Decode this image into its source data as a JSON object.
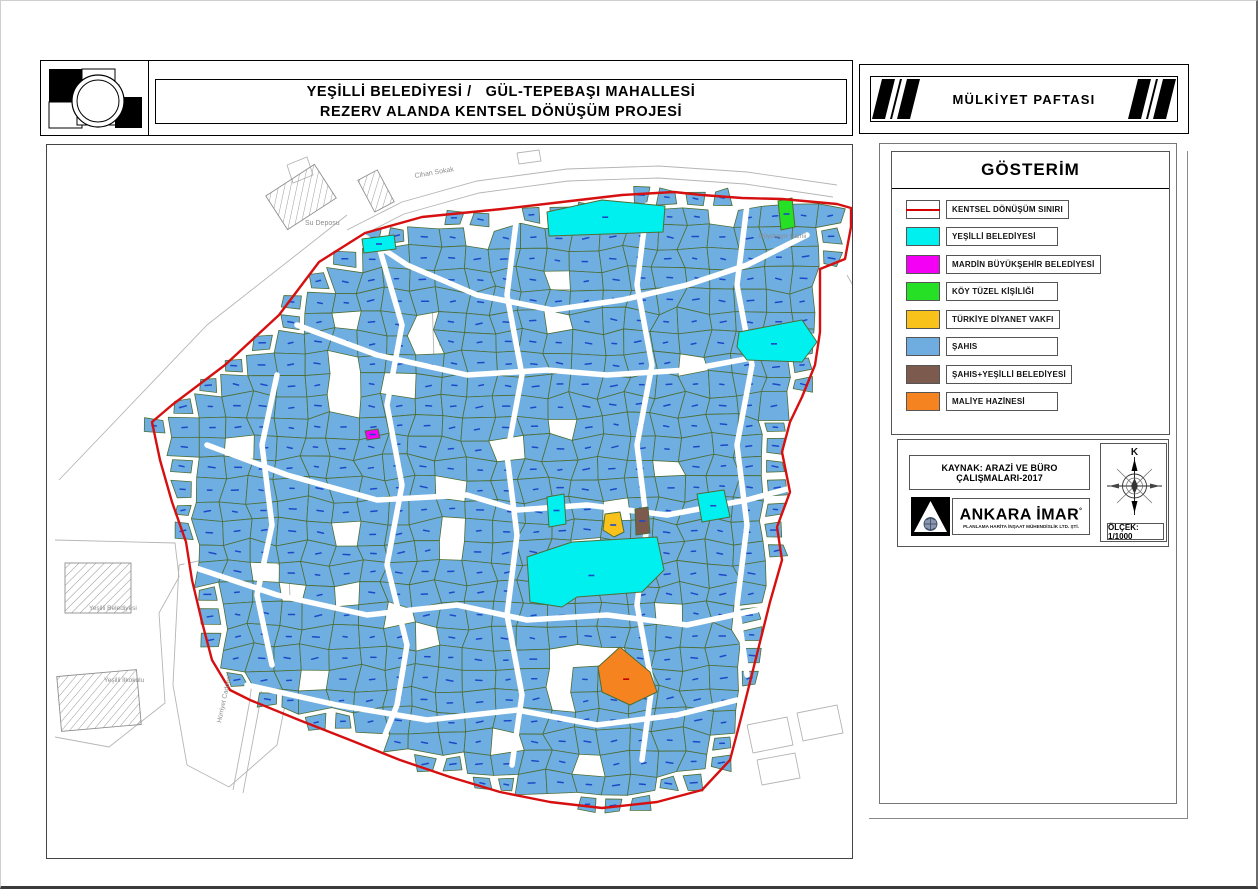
{
  "header": {
    "title_line1": "YEŞİLLİ BELEDİYESİ /   GÜL-TEPEBAŞI MAHALLESİ",
    "title_line2": "REZERV ALANDA KENTSEL DÖNÜŞÜM PROJESİ",
    "right_title": "MÜLKİYET PAFTASI"
  },
  "legend": {
    "title": "GÖSTERİM",
    "items": [
      {
        "label": "KENTSEL DÖNÜŞÜM SINIRI",
        "type": "line",
        "color": "#d40000"
      },
      {
        "label": "YEŞİLLİ BELEDİYESİ",
        "type": "fill",
        "color": "#00f0f0"
      },
      {
        "label": "MARDİN BÜYÜKŞEHİR BELEDİYESİ",
        "type": "fill",
        "color": "#f400f4"
      },
      {
        "label": "KÖY TÜZEL KİŞİLİĞİ",
        "type": "fill",
        "color": "#25e025"
      },
      {
        "label": "TÜRKİYE DİYANET VAKFI",
        "type": "fill",
        "color": "#f8c21a"
      },
      {
        "label": "ŞAHIS",
        "type": "fill",
        "color": "#6face0"
      },
      {
        "label": "ŞAHIS+YEŞİLLİ BELEDİYESİ",
        "type": "fill",
        "color": "#7c5a4e"
      },
      {
        "label": "MALİYE HAZİNESİ",
        "type": "fill",
        "color": "#f5831f"
      }
    ]
  },
  "source": {
    "kaynak": "KAYNAK: ARAZİ VE BÜRO ÇALIŞMALARI-2017",
    "company": "ANKARA İMAR",
    "company_mark": "°",
    "company_sub": "PLANLAMA HARİTA İNŞAAT MÜHENDİSLİK LTD. ŞTİ.",
    "scale": "ÖLÇEK: 1/1000",
    "north_label": "K"
  },
  "map": {
    "colors": {
      "boundary": "#d61010",
      "parcel_fill": "#6faee0",
      "parcel_stroke": "#4d6e35",
      "dash": "#1d49c8",
      "dash_orange": "#c00000",
      "outside_stroke": "#b5b5b5",
      "label": "#8d8d8d",
      "cyan": "#00f0f0",
      "green": "#25e025",
      "magenta": "#f400f4",
      "yellow": "#f8c21a",
      "brown": "#7c5a4e",
      "orange": "#f5831f"
    },
    "boundary": [
      [
        318,
        88
      ],
      [
        375,
        72
      ],
      [
        455,
        64
      ],
      [
        515,
        57
      ],
      [
        575,
        50
      ],
      [
        627,
        47
      ],
      [
        655,
        50
      ],
      [
        695,
        53
      ],
      [
        735,
        54
      ],
      [
        790,
        59
      ],
      [
        804,
        63
      ],
      [
        804,
        82
      ],
      [
        798,
        114
      ],
      [
        773,
        124
      ],
      [
        773,
        187
      ],
      [
        768,
        220
      ],
      [
        755,
        252
      ],
      [
        743,
        277
      ],
      [
        735,
        307
      ],
      [
        743,
        347
      ],
      [
        730,
        382
      ],
      [
        735,
        415
      ],
      [
        723,
        457
      ],
      [
        713,
        497
      ],
      [
        703,
        537
      ],
      [
        693,
        577
      ],
      [
        683,
        615
      ],
      [
        655,
        645
      ],
      [
        610,
        657
      ],
      [
        555,
        663
      ],
      [
        503,
        657
      ],
      [
        453,
        647
      ],
      [
        403,
        632
      ],
      [
        353,
        615
      ],
      [
        303,
        595
      ],
      [
        252,
        575
      ],
      [
        203,
        555
      ],
      [
        183,
        545
      ],
      [
        165,
        515
      ],
      [
        155,
        477
      ],
      [
        145,
        435
      ],
      [
        139,
        397
      ],
      [
        125,
        357
      ],
      [
        113,
        315
      ],
      [
        105,
        277
      ],
      [
        125,
        260
      ],
      [
        178,
        220
      ],
      [
        232,
        170
      ],
      [
        272,
        117
      ]
    ],
    "generator": {
      "seed": 7,
      "x0": 95,
      "x1": 812,
      "y0": 40,
      "y1": 672,
      "sx": 27,
      "sy": 21,
      "jx": 11,
      "jy": 9,
      "skip": 0.07
    },
    "streets": [
      [
        [
          318,
          92
        ],
        [
          360,
          120
        ],
        [
          430,
          150
        ],
        [
          505,
          165
        ],
        [
          575,
          155
        ],
        [
          640,
          140
        ],
        [
          700,
          120
        ],
        [
          760,
          90
        ]
      ],
      [
        [
          250,
          180
        ],
        [
          330,
          210
        ],
        [
          420,
          230
        ],
        [
          500,
          225
        ],
        [
          560,
          230
        ],
        [
          640,
          225
        ],
        [
          720,
          210
        ],
        [
          770,
          190
        ]
      ],
      [
        [
          160,
          300
        ],
        [
          240,
          330
        ],
        [
          330,
          355
        ],
        [
          420,
          350
        ],
        [
          470,
          365
        ],
        [
          540,
          360
        ],
        [
          620,
          370
        ],
        [
          700,
          355
        ],
        [
          755,
          340
        ]
      ],
      [
        [
          140,
          420
        ],
        [
          230,
          450
        ],
        [
          320,
          470
        ],
        [
          410,
          460
        ],
        [
          480,
          475
        ],
        [
          560,
          470
        ],
        [
          640,
          480
        ],
        [
          710,
          465
        ]
      ],
      [
        [
          200,
          540
        ],
        [
          290,
          560
        ],
        [
          380,
          575
        ],
        [
          470,
          565
        ],
        [
          550,
          580
        ],
        [
          630,
          570
        ],
        [
          690,
          555
        ]
      ],
      [
        [
          330,
          95
        ],
        [
          355,
          180
        ],
        [
          340,
          260
        ],
        [
          355,
          340
        ],
        [
          340,
          420
        ],
        [
          360,
          500
        ],
        [
          350,
          560
        ],
        [
          330,
          610
        ]
      ],
      [
        [
          470,
          70
        ],
        [
          460,
          150
        ],
        [
          475,
          230
        ],
        [
          460,
          310
        ],
        [
          470,
          390
        ],
        [
          460,
          470
        ],
        [
          475,
          550
        ],
        [
          465,
          620
        ]
      ],
      [
        [
          600,
          60
        ],
        [
          590,
          140
        ],
        [
          605,
          220
        ],
        [
          590,
          300
        ],
        [
          600,
          380
        ],
        [
          590,
          460
        ],
        [
          605,
          540
        ],
        [
          595,
          615
        ]
      ],
      [
        [
          700,
          60
        ],
        [
          690,
          140
        ],
        [
          705,
          220
        ],
        [
          690,
          300
        ],
        [
          700,
          380
        ],
        [
          690,
          460
        ],
        [
          700,
          530
        ]
      ],
      [
        [
          230,
          230
        ],
        [
          215,
          300
        ],
        [
          225,
          380
        ],
        [
          210,
          450
        ],
        [
          225,
          520
        ]
      ]
    ],
    "special_parcels": [
      {
        "color": "cyan",
        "points": [
          [
            500,
            67
          ],
          [
            555,
            55
          ],
          [
            618,
            61
          ],
          [
            616,
            87
          ],
          [
            502,
            91
          ]
        ]
      },
      {
        "color": "cyan",
        "points": [
          [
            315,
            94
          ],
          [
            347,
            90
          ],
          [
            349,
            104
          ],
          [
            317,
            108
          ]
        ]
      },
      {
        "color": "green",
        "points": [
          [
            731,
            56
          ],
          [
            745,
            53
          ],
          [
            748,
            82
          ],
          [
            734,
            85
          ]
        ]
      },
      {
        "color": "cyan",
        "points": [
          [
            692,
            187
          ],
          [
            755,
            175
          ],
          [
            770,
            197
          ],
          [
            755,
            217
          ],
          [
            700,
            215
          ],
          [
            690,
            202
          ]
        ]
      },
      {
        "color": "magenta",
        "points": [
          [
            318,
            286
          ],
          [
            331,
            284
          ],
          [
            333,
            293
          ],
          [
            320,
            295
          ]
        ]
      },
      {
        "color": "cyan",
        "points": [
          [
            500,
            352
          ],
          [
            517,
            349
          ],
          [
            519,
            379
          ],
          [
            502,
            382
          ]
        ]
      },
      {
        "color": "cyan",
        "points": [
          [
            650,
            349
          ],
          [
            677,
            345
          ],
          [
            683,
            372
          ],
          [
            655,
            377
          ]
        ]
      },
      {
        "color": "yellow",
        "points": [
          [
            558,
            369
          ],
          [
            573,
            367
          ],
          [
            577,
            387
          ],
          [
            567,
            392
          ],
          [
            556,
            385
          ]
        ]
      },
      {
        "color": "brown",
        "points": [
          [
            588,
            364
          ],
          [
            601,
            362
          ],
          [
            603,
            388
          ],
          [
            589,
            390
          ]
        ]
      },
      {
        "color": "cyan",
        "points": [
          [
            480,
            412
          ],
          [
            525,
            397
          ],
          [
            610,
            392
          ],
          [
            617,
            425
          ],
          [
            595,
            447
          ],
          [
            530,
            452
          ],
          [
            515,
            462
          ],
          [
            483,
            457
          ]
        ]
      },
      {
        "color": "orange",
        "points": [
          [
            573,
            502
          ],
          [
            603,
            527
          ],
          [
            610,
            547
          ],
          [
            583,
            560
          ],
          [
            555,
            547
          ],
          [
            551,
            522
          ]
        ]
      }
    ],
    "decor_paths": [
      [
        [
          12,
          335
        ],
        [
          160,
          180
        ],
        [
          300,
          70
        ]
      ],
      [
        [
          385,
          150
        ],
        [
          533,
          144
        ],
        [
          538,
          242
        ],
        [
          388,
          250
        ],
        [
          385,
          150
        ]
      ],
      [
        [
          392,
          200
        ],
        [
          530,
          195
        ]
      ],
      [
        [
          300,
          85
        ],
        [
          355,
          57
        ],
        [
          430,
          36
        ],
        [
          520,
          24
        ],
        [
          612,
          21
        ],
        [
          700,
          27
        ],
        [
          790,
          40
        ]
      ],
      [
        [
          302,
          97
        ],
        [
          357,
          69
        ],
        [
          432,
          48
        ],
        [
          521,
          36
        ],
        [
          611,
          33
        ],
        [
          698,
          39
        ],
        [
          786,
          52
        ]
      ],
      [
        [
          8,
          395
        ],
        [
          128,
          398
        ],
        [
          132,
          432
        ],
        [
          112,
          468
        ],
        [
          118,
          558
        ],
        [
          62,
          602
        ],
        [
          8,
          592
        ]
      ],
      [
        [
          132,
          420
        ],
        [
          215,
          403
        ],
        [
          242,
          430
        ],
        [
          246,
          520
        ],
        [
          230,
          600
        ],
        [
          182,
          642
        ],
        [
          140,
          620
        ],
        [
          126,
          540
        ],
        [
          132,
          420
        ]
      ],
      [
        [
          186,
          645
        ],
        [
          202,
          560
        ],
        [
          210,
          502
        ]
      ],
      [
        [
          196,
          648
        ],
        [
          212,
          563
        ],
        [
          220,
          505
        ]
      ],
      [
        [
          700,
          580
        ],
        [
          740,
          572
        ],
        [
          746,
          600
        ],
        [
          706,
          608
        ],
        [
          700,
          580
        ]
      ],
      [
        [
          750,
          568
        ],
        [
          790,
          560
        ],
        [
          796,
          588
        ],
        [
          756,
          596
        ],
        [
          750,
          568
        ]
      ],
      [
        [
          710,
          615
        ],
        [
          748,
          608
        ],
        [
          753,
          633
        ],
        [
          715,
          640
        ],
        [
          710,
          615
        ]
      ],
      [
        [
          800,
          130
        ],
        [
          826,
          176
        ],
        [
          818,
          256
        ]
      ],
      [
        [
          806,
          300
        ],
        [
          830,
          350
        ],
        [
          822,
          420
        ]
      ],
      [
        [
          240,
          20
        ],
        [
          260,
          12
        ],
        [
          266,
          30
        ],
        [
          246,
          38
        ],
        [
          240,
          20
        ]
      ],
      [
        [
          470,
          8
        ],
        [
          492,
          5
        ],
        [
          494,
          16
        ],
        [
          472,
          19
        ],
        [
          470,
          8
        ]
      ]
    ],
    "hatched_buildings": [
      {
        "x": 225,
        "y": 32,
        "w": 58,
        "h": 40,
        "rot": -33
      },
      {
        "x": 318,
        "y": 28,
        "w": 22,
        "h": 36,
        "rot": -28
      },
      {
        "x": 18,
        "y": 418,
        "w": 66,
        "h": 50,
        "rot": 0
      },
      {
        "x": 12,
        "y": 528,
        "w": 80,
        "h": 55,
        "rot": -5
      }
    ],
    "tree": {
      "cx": 218,
      "cy": 462,
      "r": 8
    },
    "labels": [
      {
        "text": "Su Deposu",
        "x": 258,
        "y": 80,
        "rot": 0,
        "size": 7
      },
      {
        "text": "Cihan Sokak",
        "x": 368,
        "y": 33,
        "rot": -10,
        "size": 7
      },
      {
        "text": "Büyükayır Camii",
        "x": 712,
        "y": 93,
        "rot": 0,
        "size": 6.5
      },
      {
        "text": "Yeşilli Belediyesi",
        "x": 42,
        "y": 465,
        "rot": 0,
        "size": 6.5
      },
      {
        "text": "Yeşilli İlkokulu",
        "x": 57,
        "y": 537,
        "rot": 0,
        "size": 6.5
      },
      {
        "text": "Hürriyet Caddesi",
        "x": 174,
        "y": 578,
        "rot": -78,
        "size": 6.5
      }
    ]
  }
}
